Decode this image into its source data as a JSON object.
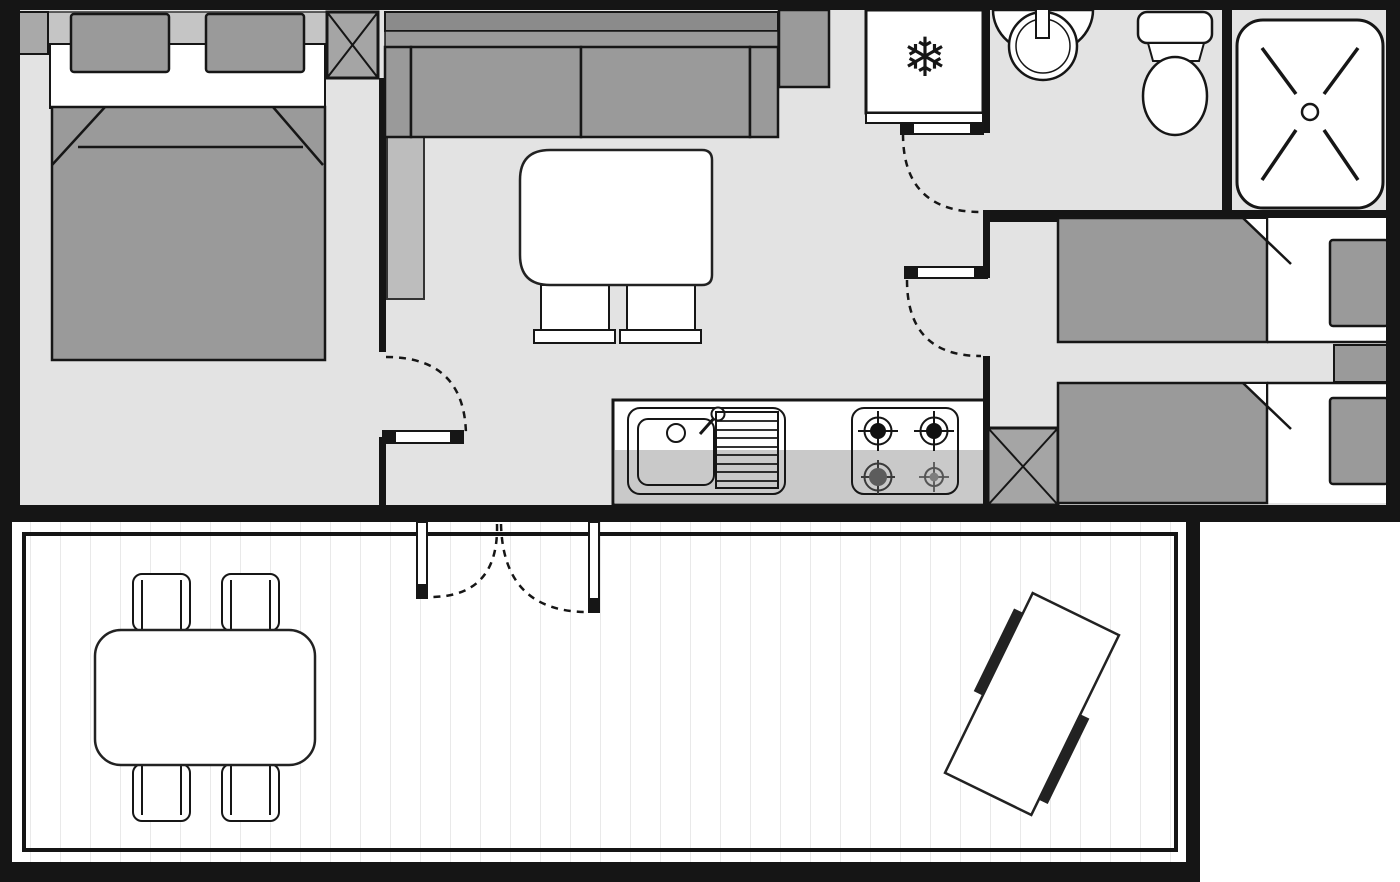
{
  "meta": {
    "type": "floor-plan",
    "width_px": 1400,
    "height_px": 882
  },
  "icons": {
    "snowflake": "❄"
  },
  "colors": {
    "wall": "#151515",
    "floor": "#e3e3e3",
    "furniture": "#9a9a9a",
    "furniture_dark": "#8b8b8b",
    "accent_light": "#c5c5c5",
    "cabinet": "#bdbdbd",
    "column": "#a5a5a5",
    "counter": "#c9c9c9",
    "white": "#ffffff",
    "outline": "#161616",
    "plank": "#e9e9e9",
    "bench": "#222222"
  },
  "rooms": [
    {
      "name": "double-bedroom"
    },
    {
      "name": "living-room"
    },
    {
      "name": "kitchen"
    },
    {
      "name": "bathroom"
    },
    {
      "name": "shower-room"
    },
    {
      "name": "twin-bedroom"
    },
    {
      "name": "deck"
    }
  ],
  "furniture": [
    "double-bed",
    "bedside-unit",
    "sofa",
    "side-cabinet",
    "coffee-table",
    "two-chairs",
    "kitchen-sink",
    "drainboard",
    "stove-4-burners",
    "fridge-freezer",
    "wash-basin",
    "toilet",
    "shower-tray",
    "twin-bed-1",
    "twin-bed-2",
    "nightstand",
    "deck-dining-table",
    "four-deck-chairs",
    "deck-picnic-table"
  ]
}
